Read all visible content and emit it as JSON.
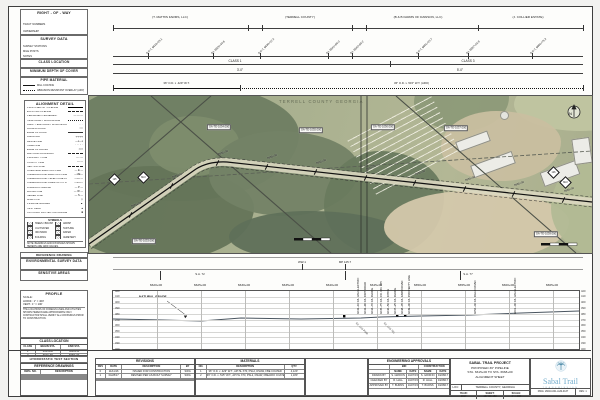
{
  "colors": {
    "logo_blue": "#74adcc",
    "logo_teal": "#4d8aa8",
    "map_base": "#a7af8e",
    "forest_green": "#6b7b60",
    "bare_field_tan": "#d4c8ab",
    "line": "#3e3e3e"
  },
  "left_panels": {
    "right_of_way": {
      "title": "RIGHT - OF - WAY",
      "subs": [
        "TRACT NUMBERS",
        "OWNERSHIP"
      ]
    },
    "survey_data": {
      "title": "SURVEY DATA",
      "subs": [
        "SURVEY STATIONS",
        "MILE POSTS",
        "NOTES"
      ]
    },
    "class_location": {
      "title": "CLASS LOCATION"
    },
    "min_cover": {
      "title": "MINIMUM DEPTH OF COVER"
    },
    "pipe_material": {
      "title": "PIPE MATERIAL",
      "items": [
        {
          "style": "solid",
          "label": "MILL COATING"
        },
        {
          "style": "dotted",
          "label": "ABRASION RESISTANT OVERLAY (ARO)"
        }
      ]
    },
    "alignment_detail": {
      "title": "ALIGNMENT DETAIL",
      "items": [
        {
          "style": "bold",
          "label": "PROPOSED 36\" PIPELINE"
        },
        {
          "style": "dash",
          "label": "EXISTING PIPELINE"
        },
        {
          "style": "glyph",
          "glyph": "—·—·—",
          "label": "PERMANENT EASEMENT"
        },
        {
          "style": "dot",
          "label": "TEMPORARY WORKSPACE"
        },
        {
          "style": "glyph",
          "glyph": "· · ·",
          "label": "ADDL. TEMPORARY WORKSPACE"
        },
        {
          "style": "glyph",
          "glyph": "══",
          "label": "ACCESS ROAD"
        },
        {
          "style": "thin",
          "label": "EDGE OF ROAD"
        },
        {
          "style": "glyph",
          "glyph": "┼┼┼┼",
          "label": "RAILROAD"
        },
        {
          "style": "glyph",
          "glyph": "—x—x",
          "label": "FENCE LINE"
        },
        {
          "style": "glyph",
          "glyph": "⌒⌒⌒",
          "label": "TREE LINE"
        },
        {
          "style": "glyph",
          "glyph": "≈≈≈",
          "label": "EDGE OF WATER"
        },
        {
          "style": "dash",
          "label": "WETLAND BOUNDARY"
        },
        {
          "style": "glyph",
          "glyph": "—··—",
          "label": "PROPERTY LINE"
        },
        {
          "style": "glyph",
          "glyph": "—·—",
          "label": "COUNTY LINE"
        },
        {
          "style": "dash",
          "label": "SECTION LINE"
        },
        {
          "style": "glyph",
          "glyph": "— E —",
          "label": "OVERHEAD ELECTRIC LINE"
        },
        {
          "style": "glyph",
          "glyph": "—UE—",
          "label": "UNDERGROUND ELECTRIC LINE"
        },
        {
          "style": "glyph",
          "glyph": "—UT—",
          "label": "UNDERGROUND TELEPHONE LINE"
        },
        {
          "style": "glyph",
          "glyph": "—FO—",
          "label": "UNDERGROUND FIBER OPTIC LINE"
        },
        {
          "style": "glyph",
          "glyph": "— P —",
          "label": "FOREIGN PIPELINE"
        },
        {
          "style": "glyph",
          "glyph": "— W —",
          "label": "WATER LINE"
        },
        {
          "style": "glyph",
          "glyph": "— S —",
          "label": "SEWER LINE"
        },
        {
          "style": "glyph",
          "glyph": "◇",
          "label": "MILE POST"
        },
        {
          "style": "glyph",
          "glyph": "▲",
          "label": "PIPELINE MARKER"
        },
        {
          "style": "glyph",
          "glyph": "●",
          "label": "TEST LEAD"
        },
        {
          "style": "glyph",
          "glyph": "■",
          "label": "CATHODIC PROTECTION ANODE"
        }
      ],
      "symbols_title": "SYMBOLS",
      "symbols": [
        "TREES / BRUSH",
        "MARSH",
        "CULTIVATED",
        "PASTURE",
        "ORCHARD",
        "WATER",
        "BUILDING",
        "CEMETERY"
      ],
      "note": "NOTE: BEARINGS AND DISTANCES SHOWN HEREON ARE GRID VALUES."
    }
  },
  "bands": {
    "right_of_way": {
      "owners": [
        {
          "x": 170,
          "label": "(T. MATHIS FARMS, LLC)"
        },
        {
          "x": 300,
          "label": "(TERRELL COUNTY)"
        },
        {
          "x": 418,
          "label": "(B & B FARMS OF DAWSON, LLC)"
        },
        {
          "x": 528,
          "label": "(J. COLLIER ESTATE)"
        }
      ],
      "ticks": [
        113,
        248,
        262,
        352,
        366,
        478,
        583
      ]
    },
    "survey": {
      "points": [
        {
          "x": 148,
          "label": "P.O.T. 6618+25.1"
        },
        {
          "x": 213,
          "label": "P.I. 6625+40.6"
        },
        {
          "x": 260,
          "label": "P.O.T. 6630+12.4"
        },
        {
          "x": 328,
          "label": "P.I. 6641+88.0"
        },
        {
          "x": 352,
          "label": "P.I. 6643+55.2"
        },
        {
          "x": 418,
          "label": "P.O.T. 6651+23.7"
        },
        {
          "x": 468,
          "label": "P.I. 6657+02.9"
        },
        {
          "x": 532,
          "label": "P.O.T. 6664+75.3"
        }
      ]
    },
    "class_location": {
      "labels": [
        {
          "x": 235,
          "label": "CLASS 1"
        },
        {
          "x": 468,
          "label": "CLASS 3"
        }
      ],
      "tick": 390
    },
    "min_cover": {
      "labels": [
        {
          "x": 240,
          "label": "3'-0\""
        },
        {
          "x": 460,
          "label": "5'-0\""
        }
      ]
    },
    "pipe_material": {
      "segments": [
        {
          "x1": 113,
          "x2": 240,
          "style": "solid",
          "label": "36\" O.D. x .429\" W.T."
        },
        {
          "x1": 240,
          "x2": 583,
          "style": "dotted",
          "label": "36\" O.D. x .515\" W.T. (ARO)"
        }
      ]
    }
  },
  "map": {
    "county_label": "TERRELL COUNTY GEORGIA",
    "north_label": "N",
    "tracts": [
      {
        "x": 55,
        "y": 145,
        "label": "GA-TE-1033.000"
      },
      {
        "x": 130,
        "y": 31,
        "label": "GA-TE-1034.000"
      },
      {
        "x": 222,
        "y": 34,
        "label": "GA-TE-1035.000"
      },
      {
        "x": 294,
        "y": 31,
        "label": "GA-TE-1036.000"
      },
      {
        "x": 367,
        "y": 32,
        "label": "GA-TE-1037.000"
      },
      {
        "x": 457,
        "y": 138,
        "label": "GA-TE-1039.000"
      }
    ],
    "mileposts": [
      {
        "x": 21,
        "y": 79,
        "label": "125"
      },
      {
        "x": 50,
        "y": 77,
        "label": "MLV"
      },
      {
        "x": 460,
        "y": 72,
        "label": "126"
      },
      {
        "x": 472,
        "y": 82,
        "label": "MLV"
      }
    ],
    "station_ticks": [
      {
        "x": 41,
        "y": 119,
        "label": "6620+00"
      },
      {
        "x": 82,
        "y": 90,
        "label": "6625+00"
      },
      {
        "x": 128,
        "y": 67,
        "label": "6630+00"
      },
      {
        "x": 177,
        "y": 71,
        "label": "6635+00"
      },
      {
        "x": 226,
        "y": 76,
        "label": "6640+00"
      },
      {
        "x": 276,
        "y": 82,
        "label": "6645+00"
      },
      {
        "x": 325,
        "y": 87,
        "label": "6650+00"
      },
      {
        "x": 375,
        "y": 93,
        "label": "6655+00"
      },
      {
        "x": 424,
        "y": 98,
        "label": "6660+00"
      },
      {
        "x": 474,
        "y": 104,
        "label": "6665+00"
      }
    ]
  },
  "strips": {
    "reference_drawing": {
      "title": "REFERENCE DRAWING"
    },
    "environmental": {
      "title": "ENVIRONMENTAL SURVEY DATA",
      "items": [
        {
          "x": 302,
          "label": "WW-1"
        },
        {
          "x": 345,
          "label": "MP 125.7"
        }
      ]
    },
    "sensitive": {
      "title": "SENSITIVE AREAS",
      "items": [
        {
          "x": 200,
          "label": "S.A. 72"
        },
        {
          "x": 468,
          "label": "S.A. 77"
        }
      ],
      "ticks": [
        160,
        345,
        460
      ]
    }
  },
  "profile": {
    "title": "PROFILE",
    "scale_label": "SCALE:",
    "scale_h": "HORIZ.: 1\" = 400'",
    "scale_v": "VERT.: 1\" = 100'",
    "note": "THE LOCATIONS OF FOREIGN LINES AND UTILITIES SHOWN HEREON ARE APPROXIMATE ONLY. CONTRACTOR SHALL VERIFY ALL CROSSINGS PRIOR TO CONSTRUCTION.",
    "legend": [
      {
        "sym": "✕",
        "label": "CLASS LOCATION CHANGE"
      },
      {
        "sym": "●",
        "label": "TRACT / OWNERSHIP SPLIT"
      },
      {
        "sym": "■",
        "label": "POINT OF INTERSECTION (P.I.)"
      },
      {
        "sym": "◆",
        "label": "MILE POST"
      },
      {
        "sym": "○",
        "label": "TEST BORE"
      }
    ],
    "natural_grade_label": "NATURAL GRADE",
    "elevations": [
      420,
      410,
      400,
      390,
      380,
      370,
      360,
      350,
      340,
      330,
      320
    ],
    "stations": [
      {
        "x": 156,
        "label": "6620+00"
      },
      {
        "x": 200,
        "label": "6625+00"
      },
      {
        "x": 244,
        "label": "6630+00"
      },
      {
        "x": 288,
        "label": "6635+00"
      },
      {
        "x": 332,
        "label": "6640+00"
      },
      {
        "x": 376,
        "label": "6645+00"
      },
      {
        "x": 420,
        "label": "6650+00"
      },
      {
        "x": 464,
        "label": "6655+00"
      },
      {
        "x": 508,
        "label": "6660+00"
      },
      {
        "x": 552,
        "label": "6665+00"
      }
    ],
    "annotations": [
      {
        "x": 360,
        "label": "6643+10 C/L U/G ELECTRIC"
      },
      {
        "x": 367,
        "label": "6643+90 C/L DIRT ROAD"
      },
      {
        "x": 374,
        "label": "6644+70 C/L FENCE"
      },
      {
        "x": 383,
        "label": "6645+75 C/L CO. RD. 155"
      },
      {
        "x": 390,
        "label": "6646+50 C/L DITCH"
      },
      {
        "x": 397,
        "label": "6647+25 C/L FENCE"
      },
      {
        "x": 404,
        "label": "6648+05 C/L FARM ROAD"
      },
      {
        "x": 411,
        "label": "6649+00 C/L PROPERTY LINE"
      },
      {
        "x": 477,
        "label": "6656+40 C/L FIELD ROAD"
      },
      {
        "x": 517,
        "label": "6661+00 C/L U/G ELECTRIC"
      }
    ],
    "below_annotations": [
      {
        "x": 357,
        "label": "EX. U/G PWR"
      },
      {
        "x": 385,
        "label": "EX. U/G TEL"
      }
    ]
  },
  "class_summary": {
    "title": "CLASS LOCATION",
    "cols": [
      "CLASS",
      "BEGIN STA.",
      "END STA."
    ],
    "rows": [
      [
        "1",
        "6615+00",
        "6640+50"
      ],
      [
        "3",
        "6640+50",
        "6668+00"
      ],
      [
        "",
        "",
        ""
      ]
    ]
  },
  "hydro": {
    "title": "HYDROSTATIC TEST SECTION"
  },
  "ref_drawings": {
    "title": "REFERENCE DRAWINGS",
    "cols": [
      "DWG. NO.",
      "DESCRIPTION"
    ],
    "rows": [
      [
        "",
        ""
      ],
      [
        "",
        ""
      ],
      [
        "",
        ""
      ],
      [
        "",
        ""
      ],
      [
        "",
        ""
      ]
    ]
  },
  "revisions": {
    "title": "REVISIONS",
    "cols": [
      "REV",
      "DATE",
      "DESCRIPTION",
      "BY"
    ],
    "rows": [
      [
        "0",
        "11/11/16",
        "ISSUED FOR CONSTRUCTION",
        "SWG"
      ],
      [
        "1",
        "04/28/17",
        "REVISED PER AS-BUILT SURVEY",
        "SWG"
      ],
      [
        "",
        "",
        "",
        ""
      ],
      [
        "",
        "",
        "",
        ""
      ]
    ]
  },
  "materials": {
    "title": "MATERIALS",
    "cols": [
      "NO.",
      "DESCRIPTION",
      "QTY."
    ],
    "rows": [
      [
        "1",
        "36\" O.D. x .429\" W.T., API 5L X70, PSL2, DSAW, FBE COATED",
        "4,120'"
      ],
      [
        "2",
        "36\" O.D. x .515\" W.T., API 5L X70, PSL2, DSAW, FBE/ARO COATED",
        "1,180'"
      ],
      [
        "",
        "",
        ""
      ]
    ]
  },
  "approvals": {
    "title": "ENGINEERING APPROVALS",
    "phases": [
      "BID",
      "CONSTRUCTION"
    ],
    "sub_cols": [
      "NAME",
      "DATE",
      "NAME",
      "DATE"
    ],
    "rows": [
      [
        "DRAWN BY",
        "S. GRIFFIN",
        "10/27/15",
        "S. GRIFFIN",
        "04/28/17"
      ],
      [
        "CHECKED BY",
        "R. HALL",
        "10/27/15",
        "R. HALL",
        "04/28/17"
      ],
      [
        "APPROVED BY",
        "T. BURNS",
        "10/27/15",
        "T. BURNS",
        "04/28/17"
      ]
    ]
  },
  "title_block": {
    "line1": "SABAL TRAIL PROJECT",
    "line2": "PROPOSED 36\" PIPELINE",
    "line3": "STA. 6615+00 TO STA. 6668+00",
    "line4": "ALIGNMENT SHEET",
    "loc_label": "LOC:",
    "loc_value": "TERRELL COUNTY, GEORGIA",
    "year_label": "YEAR:",
    "year": "2017",
    "sheet_label": "SHEET:",
    "sheet": "137 OF 480",
    "scale_label": "SCALE:",
    "scale": "1\" = 400'",
    "dwg_label": "DWG:",
    "dwg": "26010-001-ALM-0137",
    "rev_label": "REV:",
    "rev": "1"
  },
  "logo": {
    "name": "Sabal Trail",
    "sub": "TRANSMISSION"
  }
}
